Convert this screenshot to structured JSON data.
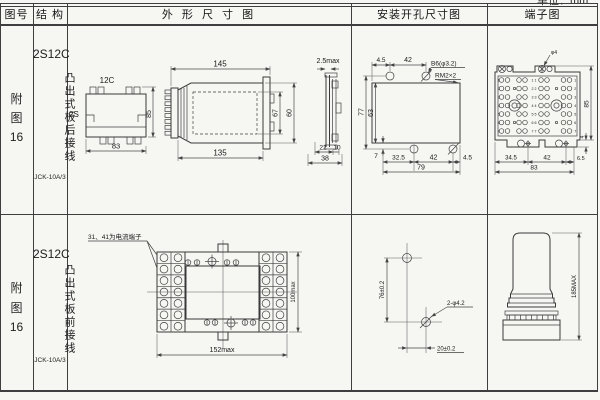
{
  "page": {
    "unit_label": "单位：mm"
  },
  "header": {
    "fig_no": "图号",
    "structure": "结 构",
    "outline": "外 形 尺 寸 图",
    "mounting": "安装开孔尺寸图",
    "terminal": "端子图"
  },
  "row1": {
    "fig": {
      "line1": "附",
      "line2": "图",
      "line3": "16"
    },
    "structure": {
      "model": "2S12C",
      "wiring": "凸出式板后接线",
      "code": "JCK-10A/3"
    },
    "outline": {
      "back_label": "12C",
      "back_side": "2S",
      "back_height": "85",
      "back_width": "83",
      "side_top": "145",
      "side_bottom": "135",
      "side_inner_h": "67",
      "side_outer_h": "60",
      "edge_thickness": "2.5max",
      "edge_front": "22",
      "edge_rear": "10",
      "edge_total": "38"
    },
    "mounting": {
      "top_offset": "4.5",
      "top_pitch": "42",
      "hole_note": "B6(φ3.2)",
      "thread_note": "RM2×2",
      "height_outer": "77",
      "height_inner": "63",
      "bottom_edge": "7",
      "bottom_d1": "32.5",
      "bottom_d2": "42",
      "bottom_d3": "4.5",
      "bottom_total": "79"
    },
    "terminal": {
      "stud_note": "φ4",
      "height": "85",
      "foot_depth": "4",
      "bottom_d1": "34.5",
      "bottom_d2": "42",
      "bottom_d3": "6.5",
      "bottom_total": "83",
      "row_numbers": [
        "1",
        "2",
        "3",
        "4",
        "5",
        "6",
        "7"
      ],
      "pair_labels": [
        "1 1",
        "2 2",
        "3 3",
        "4 4",
        "5 5",
        "6 6",
        "7 7"
      ]
    }
  },
  "row2": {
    "fig": {
      "line1": "附",
      "line2": "图",
      "line3": "16"
    },
    "structure": {
      "model": "2S12C",
      "wiring": "凸出式板前接线",
      "code": "JCK-10A/3"
    },
    "outline": {
      "note": "31、41为电流端子",
      "width": "152max",
      "height": "100max"
    },
    "mounting": {
      "vertical": "76±0.2",
      "horizontal": "20±0.2",
      "holes_note": "2-φ4.2"
    },
    "terminal": {
      "height": "185MAX"
    }
  }
}
